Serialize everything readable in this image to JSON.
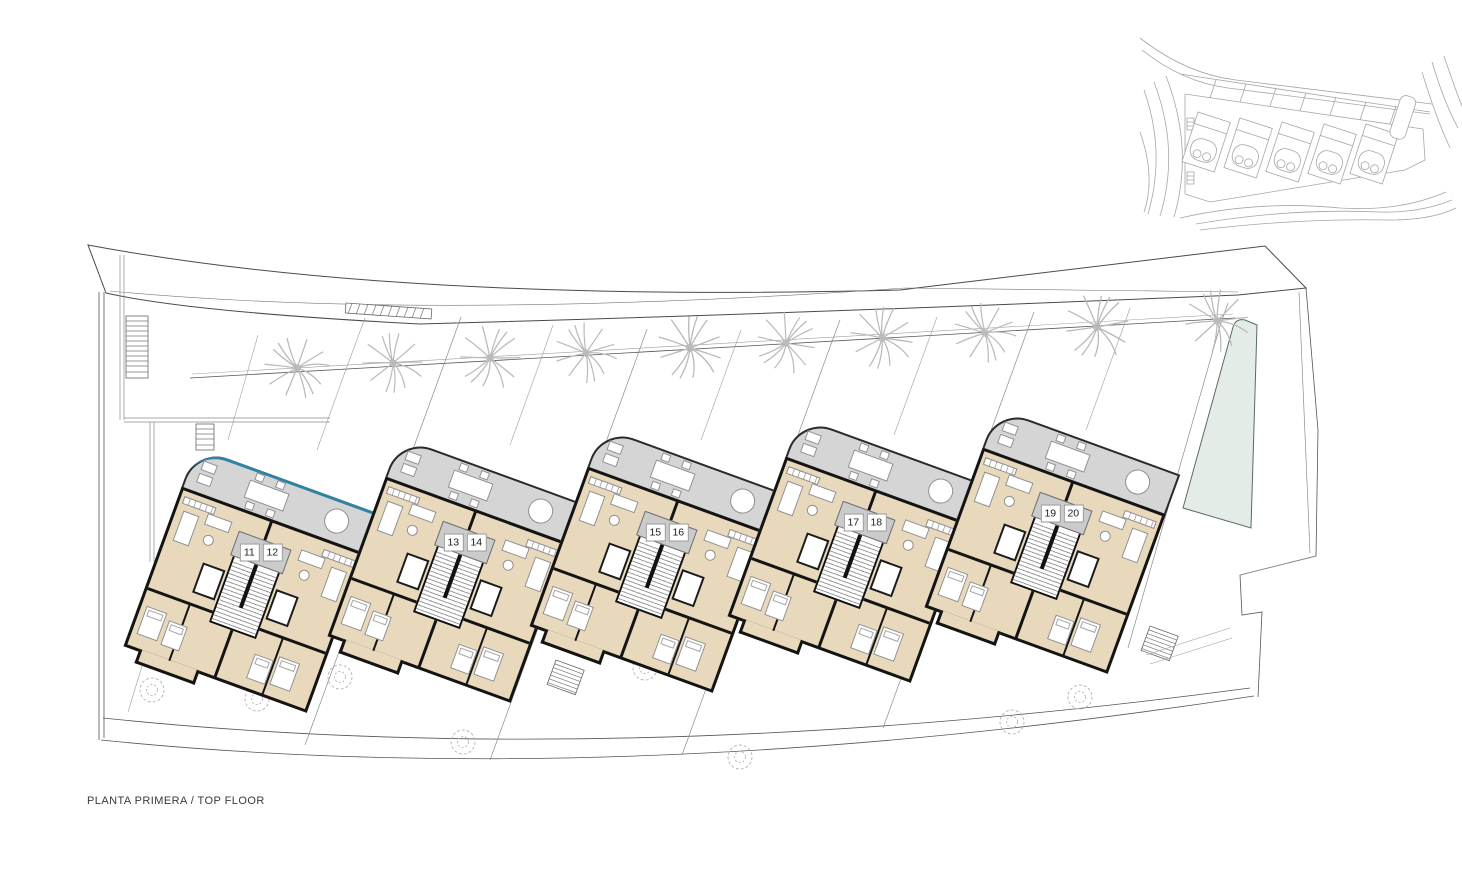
{
  "document": {
    "caption": "PLANTA PRIMERA / TOP FLOOR"
  },
  "buildings": [
    {
      "name": "building-block-1",
      "units": [
        "11",
        "12"
      ]
    },
    {
      "name": "building-block-2",
      "units": [
        "13",
        "14"
      ]
    },
    {
      "name": "building-block-3",
      "units": [
        "15",
        "16"
      ]
    },
    {
      "name": "building-block-4",
      "units": [
        "17",
        "18"
      ]
    },
    {
      "name": "building-block-5",
      "units": [
        "19",
        "20"
      ]
    }
  ],
  "colors": {
    "paper": "#ffffff",
    "floor": "#e9d9bc",
    "terrace": "#d5d5d5",
    "wall": "#141414",
    "line": "#555555",
    "lightline": "#9a9a9a",
    "veg": "#b9b9b9",
    "pool": "#e4ece7",
    "balustrade": "#2e85a3",
    "plate": "#cbcbcb",
    "text": "#3a3a3a",
    "keymap": "#a6a6a6"
  }
}
